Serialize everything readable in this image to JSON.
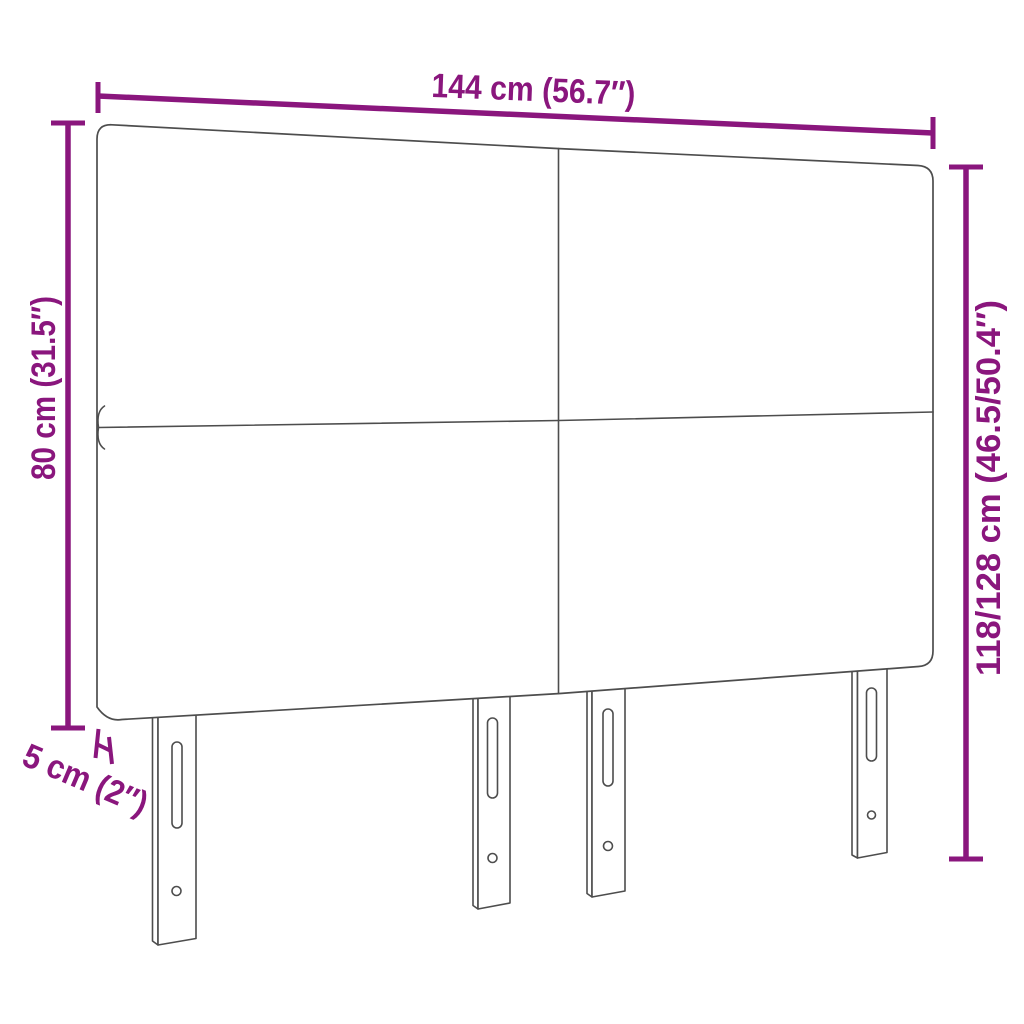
{
  "colors": {
    "accent": "#8a167d",
    "outline": "#4d4d4d",
    "background": "#ffffff"
  },
  "dimensions": {
    "width": {
      "label": "144 cm (56.7″)"
    },
    "height_left": {
      "label": "80 cm (31.5″)"
    },
    "height_right": {
      "label": "118/128 cm (46.5/50.4″)"
    },
    "depth": {
      "label": "5 cm (2″)"
    }
  }
}
